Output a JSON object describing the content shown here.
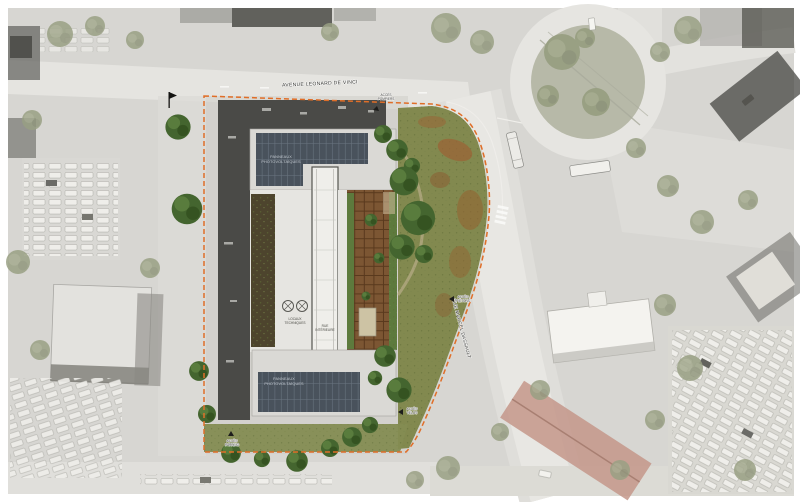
{
  "colors": {
    "boundary": "#e06e28",
    "solar_panels": "#49525c",
    "pergola_wood": "#7c5633",
    "meadow_green": "#82894f",
    "tree_green": "#44652f",
    "roof_charcoal": "#4a4a47",
    "roof_light": "#dad9d5"
  },
  "streets": {
    "avenue": "AVENUE LEONARD DE VINCI",
    "rue": "RUE MARCEL DASSAULT"
  },
  "roof": {
    "solar_north_l1": "PANNEAUX",
    "solar_north_l2": "PHOTOVOLTAÏQUES",
    "solar_south_l1": "PANNEAUX",
    "solar_south_l2": "PHOTOVOLTAÏQUES"
  },
  "courtyard": {
    "atrium_l1": "RUE",
    "atrium_l2": "INTÉRIEURE",
    "tech_l1": "LOCAUX",
    "tech_l2": "TECHNIQUES"
  },
  "access": {
    "pompiers_l1": "ACCÈS",
    "pompiers_l2": "POMPIERS",
    "pietons_l1": "ACCÈS",
    "pietons_l2": "PIÉTONS",
    "velos_l1": "ACCÈS",
    "velos_l2": "VÉLOS",
    "parking_l1": "ACCÈS",
    "parking_l2": "PARKING"
  }
}
